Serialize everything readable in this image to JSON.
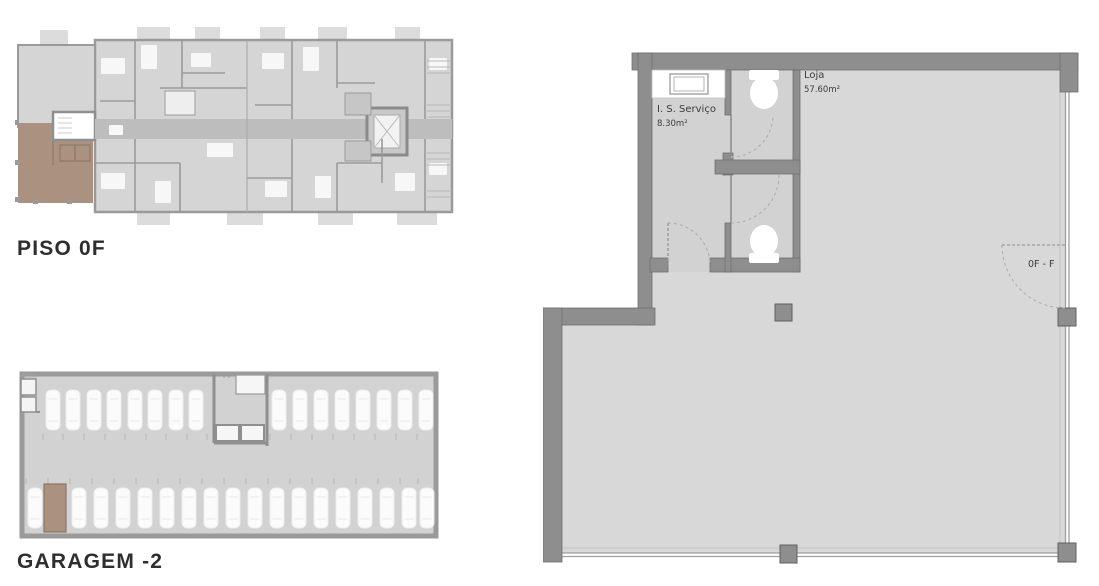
{
  "plans": {
    "piso0f": {
      "title": "PISO 0F"
    },
    "garagem": {
      "title": "GARAGEM -2"
    },
    "unit": {
      "rooms": [
        {
          "name": "I. S. Serviço",
          "area": "8.30m²"
        },
        {
          "name": "Loja",
          "area": "57.60m²"
        }
      ],
      "door_label": "0F - F"
    }
  },
  "colors": {
    "highlight": "#ab9280",
    "highlight_stroke": "#8d7563",
    "wall": "#8e8e8e",
    "floor": "#d8d8d8",
    "floor_dark": "#d2d2d2",
    "corridor": "#bdbdbd",
    "title_text": "#2e2e2e",
    "plan_text": "#3c3c3c"
  }
}
